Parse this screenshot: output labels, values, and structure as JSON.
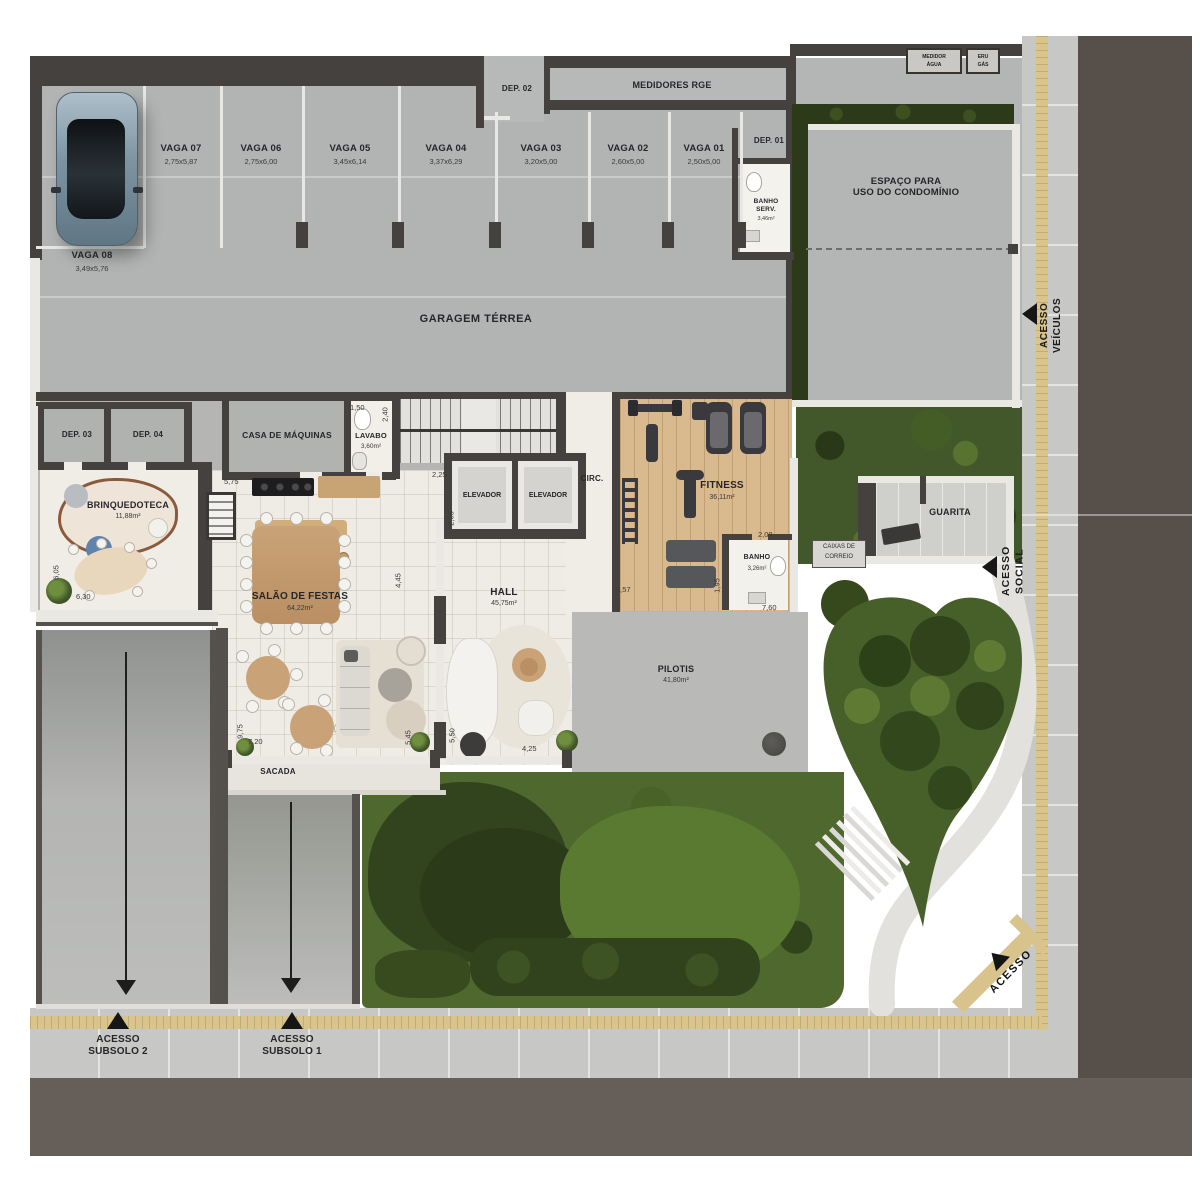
{
  "colors": {
    "asphalt": "#5a534d",
    "sidewalk": "#c7c8c6",
    "tactile_yellow": "#d9c48c",
    "slab_gray": "#b2b4b4",
    "wall_dark": "#45413e",
    "wall_white": "#eae8e3",
    "floor_white": "#efece5",
    "wood": "#c9a377",
    "fitness_floor": "#d9ba8e",
    "garden_green": "#47602a",
    "hedge_green": "#2c3a1a",
    "path_white": "#e2e1dd"
  },
  "parking": {
    "garage_label": "GARAGEM TÉRREA",
    "spots": [
      {
        "name": "VAGA 07",
        "dims": "2,75x5,87"
      },
      {
        "name": "VAGA 06",
        "dims": "2,75x6,00"
      },
      {
        "name": "VAGA 05",
        "dims": "3,45x6,14"
      },
      {
        "name": "VAGA 04",
        "dims": "3,37x6,29"
      },
      {
        "name": "VAGA 03",
        "dims": "3,20x5,00"
      },
      {
        "name": "VAGA 02",
        "dims": "2,60x5,00"
      },
      {
        "name": "VAGA 01",
        "dims": "2,50x5,00"
      }
    ],
    "vaga08": {
      "name": "VAGA 08",
      "dims": "3,49x5,76"
    }
  },
  "rooms": {
    "dep01": "DEP. 01",
    "dep02": "DEP. 02",
    "dep03": "DEP. 03",
    "dep04": "DEP. 04",
    "medidores": "MEDIDORES RGE",
    "medidor_agua": "MEDIDOR\nÁGUA",
    "eru_gas": "ERU\nGÁS",
    "banho_serv": {
      "name": "BANHO\nSERV.",
      "area": "3,46m²"
    },
    "espaco": "ESPAÇO PARA\nUSO DO CONDOMÍNIO",
    "casa_maquinas": "CASA DE MÁQUINAS",
    "lavabo": {
      "name": "LAVABO",
      "area": "3,60m²"
    },
    "brinquedoteca": {
      "name": "BRINQUEDOTECA",
      "area": "11,88m²"
    },
    "elevador": "ELEVADOR",
    "circ": "CIRC.",
    "fitness": {
      "name": "FITNESS",
      "area": "36,11m²"
    },
    "banho": {
      "name": "BANHO",
      "area": "3,26m²"
    },
    "guarita": "GUARITA",
    "caixas": "CAIXAS DE\nCORREIO",
    "salao": {
      "name": "SALÃO DE FESTAS",
      "area": "64,22m²"
    },
    "hall": {
      "name": "HALL",
      "area": "45,75m²"
    },
    "pilotis": {
      "name": "PILOTIS",
      "area": "41,80m²"
    },
    "sacada": "SACADA"
  },
  "access": {
    "social": "ACESSO\nSOCIAL",
    "veiculos": "ACESSO\nVEÍCULOS",
    "subsolo1": "ACESSO\nSUBSOLO 1",
    "subsolo2": "ACESSO\nSUBSOLO 2",
    "acesso": "ACESSO"
  },
  "dims": {
    "d150": "1,50",
    "d240": "2,40",
    "d575": "5,75",
    "d225": "2,25",
    "d205": "2,05",
    "d445": "4,45",
    "d605": "6,05",
    "d630": "6,30",
    "d975": "9,75",
    "d720": "7,20",
    "d545": "5,45",
    "d550": "5,50",
    "d425": "4,25",
    "d357": "3,57",
    "d195": "1,95",
    "d208": "2,08",
    "d760": "7,60"
  }
}
